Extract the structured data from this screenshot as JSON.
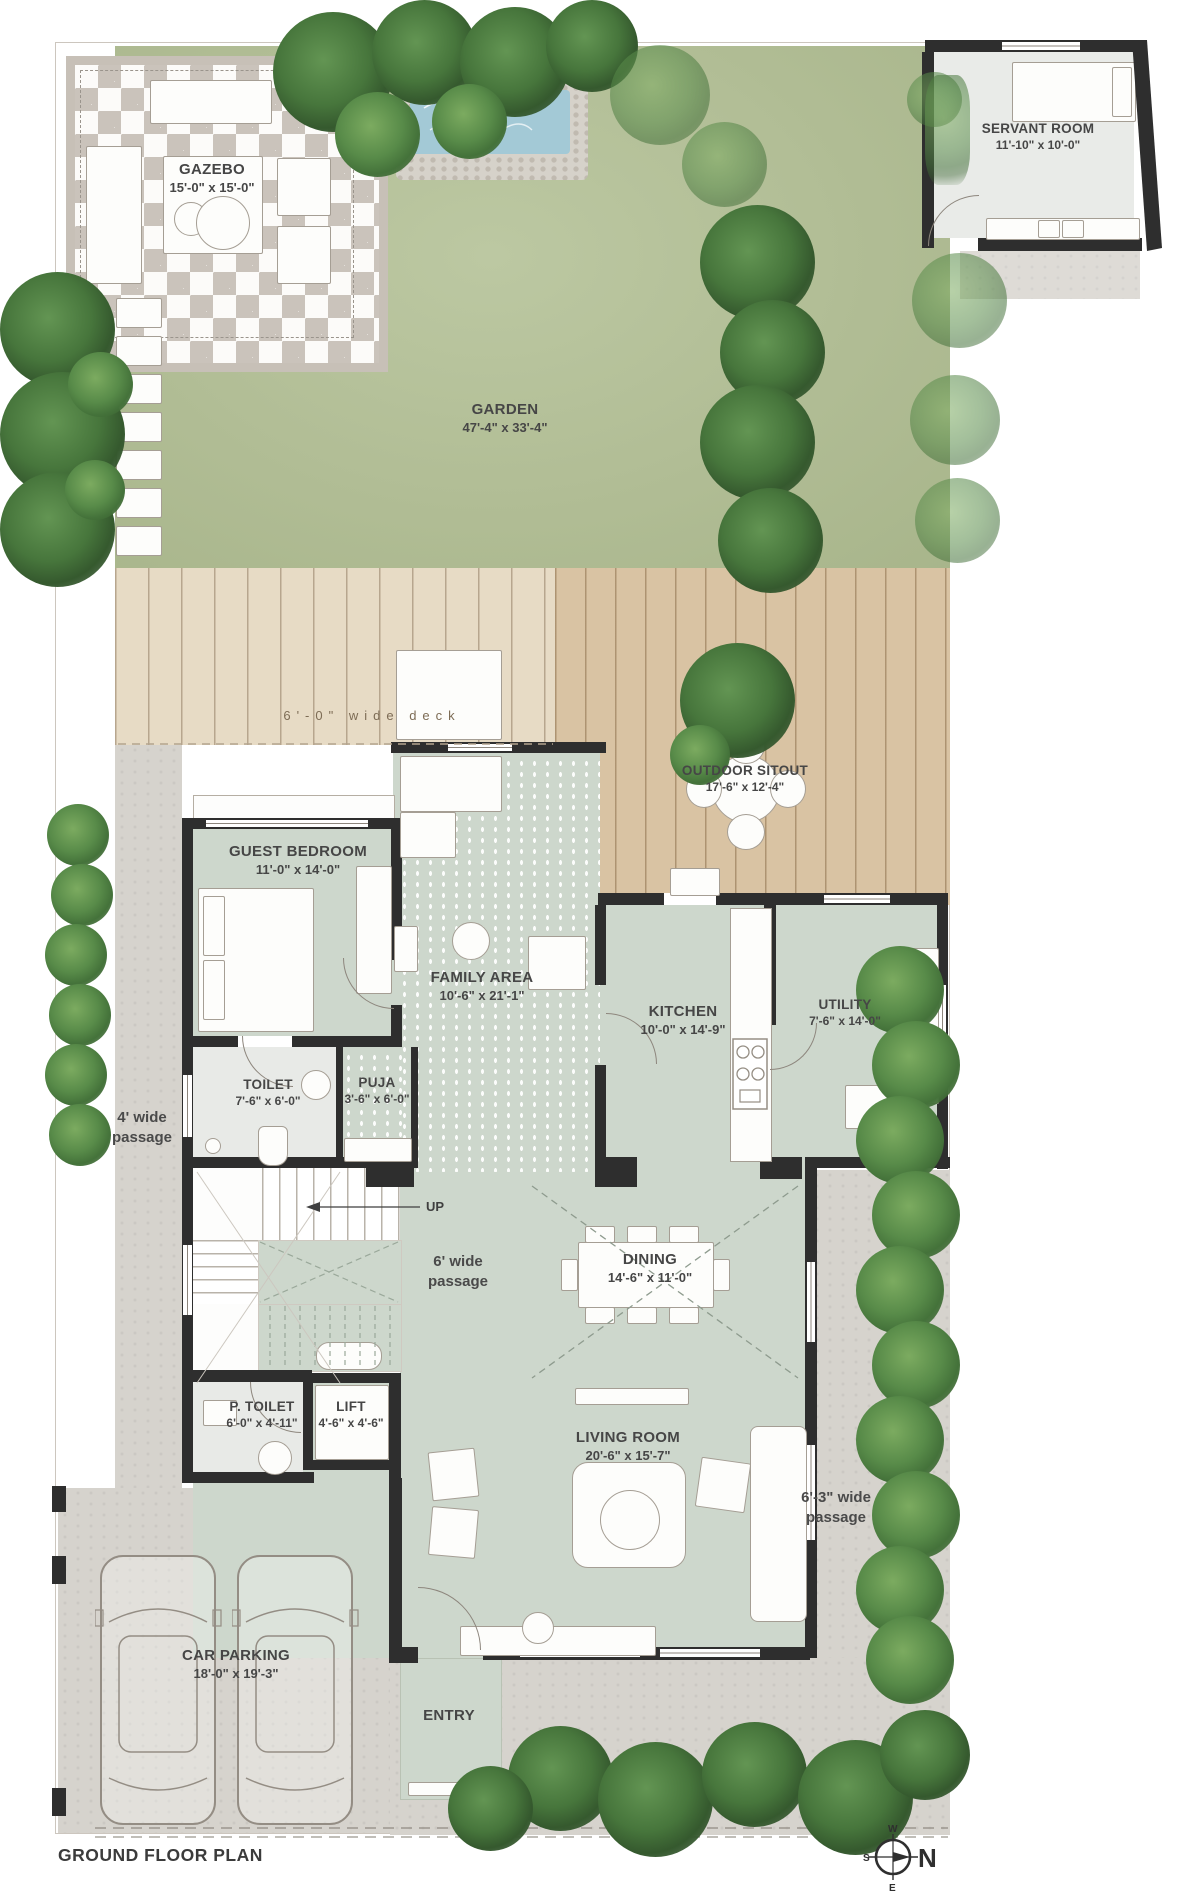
{
  "title": "GROUND FLOOR PLAN",
  "compass": {
    "north": "N",
    "west": "W",
    "south": "S",
    "east": "E"
  },
  "colors": {
    "garden_green": "#b1bd95",
    "deck_light": "#e7dbc5",
    "deck_dark": "#d9c3a3",
    "room_sage": "#cdd7cc",
    "paving_gray": "#d6d3cd",
    "bath_gray": "#e8eae7",
    "wall_dark": "#2e2e2e",
    "water_blue": "#a3c9d6",
    "tree_green": "#588b49"
  },
  "labels": {
    "gazebo": {
      "name": "GAZEBO",
      "dims": "15'-0\" x 15'-0\""
    },
    "servant_room": {
      "name": "SERVANT ROOM",
      "dims": "11'-10\" x 10'-0\""
    },
    "garden": {
      "name": "GARDEN",
      "dims": "47'-4\" x 33'-4\""
    },
    "deck": {
      "name": "6'-0\" wide deck"
    },
    "outdoor_sitout": {
      "name": "OUTDOOR SITOUT",
      "dims": "17'-6\" x 12'-4\""
    },
    "guest_bedroom": {
      "name": "GUEST BEDROOM",
      "dims": "11'-0\" x 14'-0\""
    },
    "family_area": {
      "name": "FAMILY AREA",
      "dims": "10'-6\" x 21'-1\""
    },
    "kitchen": {
      "name": "KITCHEN",
      "dims": "10'-0\" x 14'-9\""
    },
    "utility": {
      "name": "UTILITY",
      "dims": "7'-6\" x 14'-0\""
    },
    "toilet": {
      "name": "TOILET",
      "dims": "7'-6\" x 6'-0\""
    },
    "puja": {
      "name": "PUJA",
      "dims": "3'-6\" x 6'-0\""
    },
    "passage_left": {
      "name": "4' wide passage"
    },
    "up": {
      "name": "UP"
    },
    "passage_center": {
      "name": "6' wide passage"
    },
    "dining": {
      "name": "DINING",
      "dims": "14'-6\" x 11'-0\""
    },
    "p_toilet": {
      "name": "P. TOILET",
      "dims": "6'-0\" x 4'-11\""
    },
    "lift": {
      "name": "LIFT",
      "dims": "4'-6\" x 4'-6\""
    },
    "living_room": {
      "name": "LIVING ROOM",
      "dims": "20'-6\" x 15'-7\""
    },
    "passage_right": {
      "name": "6'-3\" wide passage"
    },
    "car_parking": {
      "name": "CAR PARKING",
      "dims": "18'-0\" x 19'-3\""
    },
    "entry": {
      "name": "ENTRY"
    }
  }
}
